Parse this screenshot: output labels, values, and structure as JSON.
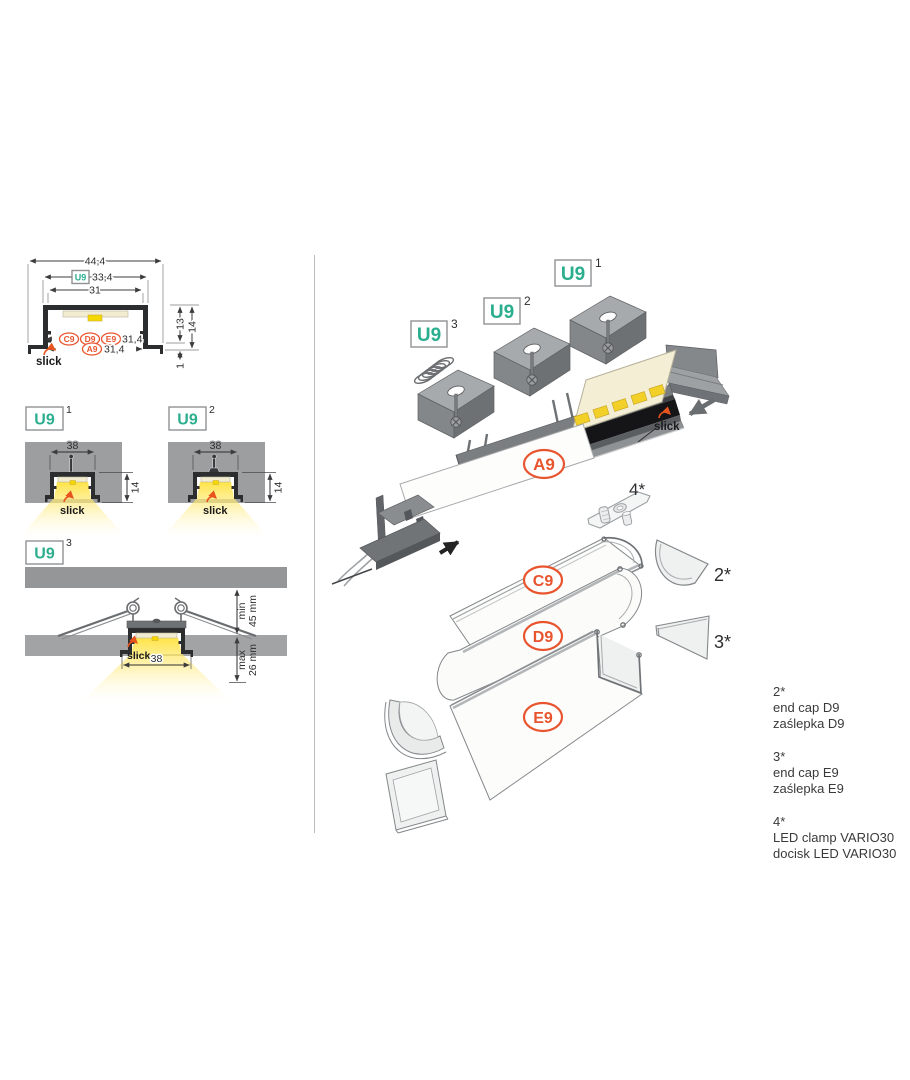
{
  "page": {
    "background": "#ffffff"
  },
  "colors": {
    "teal": "#2bae8e",
    "orange": "#e8542e",
    "profile_dark": "#2b2d2f",
    "ceiling_gray": "#9c9ea0",
    "glow_yellow": "#ffe23c",
    "divider": "#bcbcbc",
    "text": "#2e2e30"
  },
  "cross_section": {
    "u9_badge": "U9",
    "slick_label": "slick",
    "dims": {
      "overall_width": "44,4",
      "recess_width": "33,4",
      "inner_width": "31",
      "inner_height": "13",
      "outer_height": "14",
      "covers_width": "31,4",
      "diffuser_width": "31,4",
      "flange_height": "1"
    },
    "cover_badges": {
      "c9": "C9",
      "d9": "D9",
      "e9": "E9",
      "a9": "A9"
    }
  },
  "variant1": {
    "badge": "U9",
    "variant_no": "1",
    "dims": {
      "width": "38",
      "height": "14"
    },
    "slick_label": "slick"
  },
  "variant2": {
    "badge": "U9",
    "variant_no": "2",
    "dims": {
      "width": "38",
      "height": "14"
    },
    "slick_label": "slick"
  },
  "variant3": {
    "badge": "U9",
    "variant_no": "3",
    "dims": {
      "min_label": "min",
      "min_value": "45 mm",
      "max_label": "max",
      "max_value": "26 mm",
      "width": "38"
    },
    "slick_label": "slick"
  },
  "exploded": {
    "mount_badges": [
      {
        "label": "U9",
        "variant_no": "1"
      },
      {
        "label": "U9",
        "variant_no": "2"
      },
      {
        "label": "U9",
        "variant_no": "3"
      }
    ],
    "part_badges": {
      "diffuser": "A9",
      "cover_flat": "C9",
      "cover_round": "D9",
      "cover_square": "E9"
    },
    "slick_label": "slick",
    "callouts": {
      "end_cap_d9": "2*",
      "end_cap_e9": "3*",
      "led_clamp": "4*"
    }
  },
  "legend": {
    "items": [
      {
        "ref": "2*",
        "name_en": "end cap D9",
        "name_pl": "zaślepka D9"
      },
      {
        "ref": "3*",
        "name_en": "end cap E9",
        "name_pl": "zaślepka E9"
      },
      {
        "ref": "4*",
        "name_en": "LED clamp VARIO30",
        "name_pl": "docisk LED VARIO30"
      }
    ]
  }
}
